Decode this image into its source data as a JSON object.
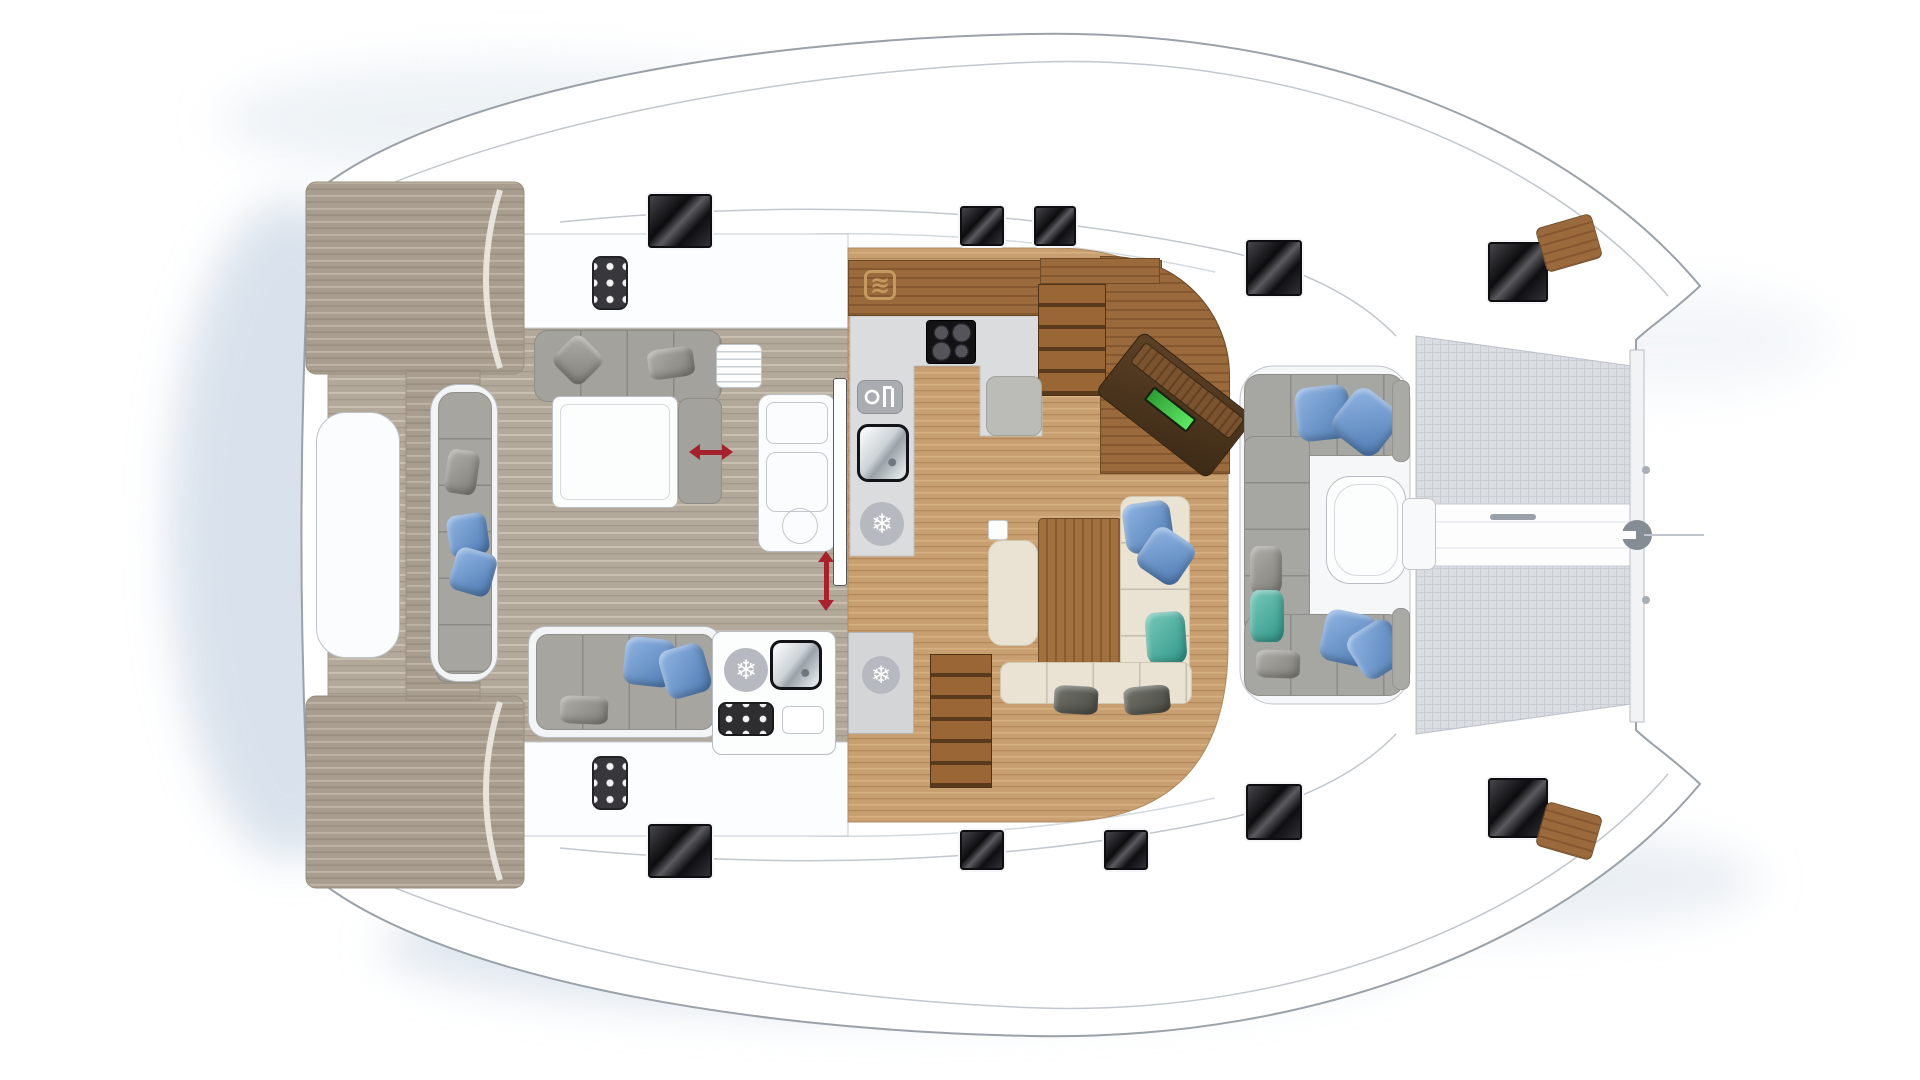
{
  "meta": {
    "subject": "catamaran-deck-plan",
    "canvas": {
      "w": 1920,
      "h": 1080
    }
  },
  "palette": {
    "hull_outline": "#9aa1a8",
    "deck_white": "#ffffff",
    "water_shadow": "#c9d6e4",
    "cockpit_teak": "#b3a99b",
    "saloon_oak": "#c89f71",
    "walnut": "#8a5b31",
    "counter_gray": "#dbdcdd",
    "sofa_gray": "#a6a5a0",
    "sofa_cream": "#eae2d2",
    "hatch_black": "#0c0c0e",
    "arrow_red": "#a5212c",
    "nav_screen_green": "#3fc24a",
    "trampoline": "#dadde2"
  },
  "glyphs": {
    "snowflake": "❄",
    "microwave": "≋"
  },
  "pillow_colors": {
    "blue": [
      "#92b6e4",
      "#4d7ab2"
    ],
    "teal": [
      "#79c9b9",
      "#2e978a"
    ],
    "gray": [
      "#aeada7",
      "#807f79"
    ],
    "dark": [
      "#72726b",
      "#4b4b45"
    ]
  },
  "items": [
    {
      "name": "stern-davit-locker",
      "kind": "box",
      "x": 316,
      "y": 412,
      "w": 84,
      "h": 246,
      "fill": "#fbfcfd",
      "stroke": "#bdc2c8",
      "r": 30
    },
    {
      "name": "stern-step-cushion-top",
      "kind": "box",
      "x": 436,
      "y": 388,
      "w": 46,
      "h": 96,
      "fill": "#9e9d98",
      "stroke": "#8a8984",
      "r": 10
    },
    {
      "name": "stern-step-cushion-bottom",
      "kind": "box",
      "x": 436,
      "y": 586,
      "w": 46,
      "h": 96,
      "fill": "#9e9d98",
      "stroke": "#8a8984",
      "r": 10
    },
    {
      "name": "transom-bench-shell",
      "kind": "box",
      "x": 430,
      "y": 384,
      "w": 68,
      "h": 298,
      "fill": "#f3f4f5",
      "stroke": "#b7bcc2",
      "r": 28
    },
    {
      "name": "transom-bench-cushions",
      "kind": "box",
      "x": 438,
      "y": 392,
      "w": 54,
      "h": 282,
      "fill": "#a6a5a0",
      "stroke": "#908f8a",
      "r": 16,
      "cls": "seam-h"
    },
    {
      "name": "transom-bench-pillow-gray",
      "kind": "pillow",
      "pc": "gray",
      "x": 446,
      "y": 450,
      "w": 32,
      "h": 44,
      "rot": 8
    },
    {
      "name": "transom-bench-pillow-blue-1",
      "kind": "pillow",
      "pc": "blue",
      "x": 448,
      "y": 514,
      "w": 40,
      "h": 42,
      "rot": -8
    },
    {
      "name": "transom-bench-pillow-blue-2",
      "kind": "pillow",
      "pc": "blue",
      "x": 452,
      "y": 550,
      "w": 42,
      "h": 44,
      "rot": 16
    },
    {
      "name": "aft-sofa-top",
      "kind": "box",
      "x": 534,
      "y": 330,
      "w": 188,
      "h": 72,
      "fill": "#a3a29d",
      "stroke": "#8d8c87",
      "r": 14,
      "cls": "seam-v"
    },
    {
      "name": "aft-sofa-top-return",
      "kind": "box",
      "x": 678,
      "y": 398,
      "w": 44,
      "h": 106,
      "fill": "#a3a29d",
      "stroke": "#8d8c87",
      "r": 10
    },
    {
      "name": "aft-sofa-top-pillow-1",
      "kind": "pillow",
      "pc": "gray",
      "x": 558,
      "y": 340,
      "w": 40,
      "h": 40,
      "rot": 45
    },
    {
      "name": "aft-sofa-top-pillow-2",
      "kind": "pillow",
      "pc": "gray",
      "x": 648,
      "y": 348,
      "w": 46,
      "h": 30,
      "rot": -8
    },
    {
      "name": "cockpit-table",
      "kind": "table",
      "x": 552,
      "y": 396,
      "w": 126,
      "h": 112,
      "r": 8
    },
    {
      "name": "aft-sofa-bottom-shell",
      "kind": "box",
      "x": 528,
      "y": 626,
      "w": 194,
      "h": 112,
      "fill": "#f3f4f5",
      "stroke": "#b7bcc2",
      "r": 18
    },
    {
      "name": "aft-sofa-bottom-cushions",
      "kind": "box",
      "x": 536,
      "y": 634,
      "w": 178,
      "h": 96,
      "fill": "#a6a5a0",
      "stroke": "#908f8a",
      "r": 12,
      "cls": "seam-v"
    },
    {
      "name": "aft-sofa-bottom-pillow-blue-1",
      "kind": "pillow",
      "pc": "blue",
      "x": 624,
      "y": 638,
      "w": 50,
      "h": 48,
      "rot": 6
    },
    {
      "name": "aft-sofa-bottom-pillow-blue-2",
      "kind": "pillow",
      "pc": "blue",
      "x": 662,
      "y": 646,
      "w": 46,
      "h": 50,
      "rot": -16
    },
    {
      "name": "aft-sofa-bottom-pillow-gray",
      "kind": "pillow",
      "pc": "gray",
      "x": 560,
      "y": 696,
      "w": 48,
      "h": 28,
      "rot": 2
    },
    {
      "name": "transom-control-panel-top",
      "kind": "sixdot",
      "x": 592,
      "y": 256,
      "w": 36,
      "h": 54
    },
    {
      "name": "transom-control-panel-bottom",
      "kind": "sixdot",
      "x": 592,
      "y": 756,
      "w": 36,
      "h": 54
    },
    {
      "name": "cockpit-louver-vent",
      "kind": "louver",
      "x": 716,
      "y": 344,
      "w": 46,
      "h": 44
    },
    {
      "name": "helm-console-base",
      "kind": "box",
      "x": 758,
      "y": 394,
      "w": 78,
      "h": 158,
      "fill": "#fbfcfd",
      "stroke": "#b8bdc3",
      "r": 12
    },
    {
      "name": "helm-console-panel-1",
      "kind": "box",
      "x": 766,
      "y": 402,
      "w": 62,
      "h": 42,
      "stroke": "#c3c8ce",
      "r": 8
    },
    {
      "name": "helm-console-panel-2",
      "kind": "box",
      "x": 766,
      "y": 452,
      "w": 62,
      "h": 60,
      "stroke": "#c3c8ce",
      "r": 10
    },
    {
      "name": "helm-console-circle",
      "kind": "circle",
      "x": 782,
      "y": 508,
      "w": 36,
      "h": 36
    },
    {
      "name": "wet-bar",
      "kind": "box",
      "x": 712,
      "y": 631,
      "w": 124,
      "h": 124,
      "fill": "#fcfdfd",
      "stroke": "#b7bcc2",
      "r": 10
    },
    {
      "name": "wet-bar-fridge-icon",
      "kind": "snowflake",
      "x": 724,
      "y": 648,
      "w": 44,
      "h": 44
    },
    {
      "name": "wet-bar-sink",
      "kind": "sink",
      "x": 770,
      "y": 640,
      "w": 52,
      "h": 50
    },
    {
      "name": "wet-bar-grill",
      "kind": "grill",
      "x": 718,
      "y": 702,
      "w": 56,
      "h": 34
    },
    {
      "name": "wet-bar-tray",
      "kind": "box",
      "x": 782,
      "y": 706,
      "w": 42,
      "h": 28,
      "fill": "#ffffff",
      "stroke": "#c3c8ce",
      "r": 6
    },
    {
      "name": "sliding-door-panel",
      "kind": "box",
      "x": 833,
      "y": 378,
      "w": 14,
      "h": 208,
      "fill": "#ffffff",
      "stroke": "#55585c",
      "r": 3
    },
    {
      "name": "door-slide-arrow",
      "kind": "arrow-v",
      "x": 818,
      "y": 552,
      "w": 16,
      "h": 58
    },
    {
      "name": "window-slide-arrow",
      "kind": "arrow-h",
      "x": 690,
      "y": 444,
      "w": 42,
      "h": 16
    },
    {
      "name": "galley-worktop",
      "kind": "wood-h",
      "x": 848,
      "y": 260,
      "w": 314,
      "h": 56
    },
    {
      "name": "microwave-icon",
      "kind": "microwave",
      "x": 864,
      "y": 270,
      "w": 32,
      "h": 30
    },
    {
      "name": "cooktop",
      "kind": "cooktop",
      "x": 926,
      "y": 320,
      "w": 50,
      "h": 44
    },
    {
      "name": "dishwasher-icon",
      "kind": "dishwasher",
      "x": 857,
      "y": 380,
      "w": 46,
      "h": 34
    },
    {
      "name": "galley-sink",
      "kind": "sink",
      "x": 857,
      "y": 424,
      "w": 52,
      "h": 58
    },
    {
      "name": "galley-fridge-icon",
      "kind": "snowflake",
      "x": 860,
      "y": 502,
      "w": 44,
      "h": 44
    },
    {
      "name": "saloon-fridge-cabinet",
      "kind": "box",
      "x": 848,
      "y": 632,
      "w": 66,
      "h": 102,
      "fill": "#d3d5d7",
      "stroke": "#b2b4b6",
      "r": 2
    },
    {
      "name": "saloon-fridge-icon",
      "kind": "snowflake",
      "x": 862,
      "y": 656,
      "w": 38,
      "h": 38
    },
    {
      "name": "walnut-corner-floor",
      "kind": "wood-h",
      "x": 1100,
      "y": 256,
      "w": 130,
      "h": 218,
      "br": "0 120px 0 0"
    },
    {
      "name": "stair-landing-port",
      "kind": "wood-h",
      "x": 1040,
      "y": 258,
      "w": 120,
      "h": 26
    },
    {
      "name": "stairs-port-hull",
      "kind": "steps",
      "x": 1038,
      "y": 284,
      "w": 68,
      "h": 112
    },
    {
      "name": "stairs-starboard-hull",
      "kind": "steps",
      "x": 930,
      "y": 654,
      "w": 62,
      "h": 134
    },
    {
      "name": "nav-seat",
      "kind": "box",
      "x": 986,
      "y": 376,
      "w": 56,
      "h": 60,
      "fill": "#bbbbb7",
      "stroke": "#a3a29d",
      "r": 10
    },
    {
      "name": "nav-desk",
      "kind": "navdesk",
      "x": 1104,
      "y": 366,
      "w": 142,
      "h": 78,
      "rot": 38
    },
    {
      "name": "saloon-side-cube",
      "kind": "box",
      "x": 988,
      "y": 520,
      "w": 20,
      "h": 20,
      "fill": "#fdfdfd",
      "stroke": "#c6cbd0",
      "r": 3
    },
    {
      "name": "dining-chaise",
      "kind": "box",
      "x": 988,
      "y": 540,
      "w": 50,
      "h": 106,
      "fill": "#eae2d2",
      "stroke": "#d2c8b2",
      "r": 14
    },
    {
      "name": "dining-table",
      "kind": "wood-v",
      "x": 1038,
      "y": 518,
      "w": 84,
      "h": 150,
      "r": 5
    },
    {
      "name": "dining-sofa",
      "kind": "box",
      "x": 1120,
      "y": 496,
      "w": 70,
      "h": 188,
      "fill": "#eae2d2",
      "stroke": "#d2c8b2",
      "r": 12,
      "cls": "seam-h"
    },
    {
      "name": "dining-sofa-pillow-blue-1",
      "kind": "pillow",
      "pc": "blue",
      "x": 1124,
      "y": 502,
      "w": 48,
      "h": 50,
      "rot": -8
    },
    {
      "name": "dining-sofa-pillow-blue-2",
      "kind": "pillow",
      "pc": "blue",
      "x": 1142,
      "y": 532,
      "w": 48,
      "h": 48,
      "rot": 34
    },
    {
      "name": "dining-sofa-pillow-teal",
      "kind": "pillow",
      "pc": "teal",
      "x": 1146,
      "y": 612,
      "w": 40,
      "h": 52,
      "rot": -4
    },
    {
      "name": "dining-bench",
      "kind": "box",
      "x": 1000,
      "y": 662,
      "w": 192,
      "h": 42,
      "fill": "#eae2d2",
      "stroke": "#d2c8b2",
      "r": 10,
      "cls": "seam-v"
    },
    {
      "name": "dining-bench-pillow-1",
      "kind": "pillow",
      "pc": "dark",
      "x": 1054,
      "y": 686,
      "w": 44,
      "h": 28,
      "rot": 3
    },
    {
      "name": "dining-bench-pillow-2",
      "kind": "pillow",
      "pc": "dark",
      "x": 1124,
      "y": 686,
      "w": 46,
      "h": 28,
      "rot": -5
    },
    {
      "name": "fwd-cockpit-sofa-top",
      "kind": "box",
      "x": 1244,
      "y": 374,
      "w": 160,
      "h": 82,
      "fill": "#a6a6a2",
      "stroke": "#8e8d88",
      "r": 16,
      "cls": "seam-v"
    },
    {
      "name": "fwd-cockpit-sofa-left",
      "kind": "box",
      "x": 1244,
      "y": 436,
      "w": 66,
      "h": 198,
      "fill": "#a6a6a2",
      "stroke": "#8e8d88",
      "r": 10,
      "cls": "seam-h"
    },
    {
      "name": "fwd-cockpit-sofa-bottom",
      "kind": "box",
      "x": 1244,
      "y": 614,
      "w": 160,
      "h": 82,
      "fill": "#a6a6a2",
      "stroke": "#8e8d88",
      "r": 16,
      "cls": "seam-v"
    },
    {
      "name": "fwd-pillow-blue-1",
      "kind": "pillow",
      "pc": "blue",
      "x": 1296,
      "y": 386,
      "w": 54,
      "h": 54,
      "rot": -6
    },
    {
      "name": "fwd-pillow-blue-2",
      "kind": "pillow",
      "pc": "blue",
      "x": 1338,
      "y": 394,
      "w": 56,
      "h": 56,
      "rot": 38
    },
    {
      "name": "fwd-pillow-gray-1",
      "kind": "pillow",
      "pc": "gray",
      "x": 1250,
      "y": 546,
      "w": 32,
      "h": 48,
      "rot": 0
    },
    {
      "name": "fwd-pillow-teal",
      "kind": "pillow",
      "pc": "teal",
      "x": 1250,
      "y": 590,
      "w": 34,
      "h": 52,
      "rot": 0
    },
    {
      "name": "fwd-pillow-gray-2",
      "kind": "pillow",
      "pc": "gray",
      "x": 1256,
      "y": 650,
      "w": 44,
      "h": 28,
      "rot": 2
    },
    {
      "name": "fwd-pillow-blue-3",
      "kind": "pillow",
      "pc": "blue",
      "x": 1322,
      "y": 612,
      "w": 52,
      "h": 52,
      "rot": 12
    },
    {
      "name": "fwd-pillow-blue-4",
      "kind": "pillow",
      "pc": "blue",
      "x": 1352,
      "y": 624,
      "w": 50,
      "h": 50,
      "rot": -32
    },
    {
      "name": "fwd-cockpit-table",
      "kind": "table",
      "x": 1326,
      "y": 476,
      "w": 80,
      "h": 108,
      "r": 24
    },
    {
      "name": "mast-step-console",
      "kind": "box",
      "x": 1402,
      "y": 498,
      "w": 34,
      "h": 72,
      "fill": "#f8f9fa",
      "stroke": "#c0c5cb",
      "r": 8
    },
    {
      "name": "trampoline-pad-top",
      "kind": "box",
      "x": 1392,
      "y": 380,
      "w": 18,
      "h": 82,
      "fill": "#a9a9a5",
      "stroke": "#949390",
      "r": 8
    },
    {
      "name": "trampoline-pad-bottom",
      "kind": "box",
      "x": 1392,
      "y": 608,
      "w": 18,
      "h": 82,
      "fill": "#a9a9a5",
      "stroke": "#949390",
      "r": 8
    },
    {
      "name": "deck-hatch-1",
      "kind": "hatch",
      "x": 648,
      "y": 194,
      "w": 64,
      "h": 54
    },
    {
      "name": "deck-hatch-2",
      "kind": "hatch",
      "x": 960,
      "y": 206,
      "w": 44,
      "h": 40
    },
    {
      "name": "deck-hatch-3",
      "kind": "hatch",
      "x": 1034,
      "y": 206,
      "w": 42,
      "h": 40
    },
    {
      "name": "deck-hatch-4",
      "kind": "hatch",
      "x": 1246,
      "y": 240,
      "w": 56,
      "h": 56
    },
    {
      "name": "deck-hatch-5",
      "kind": "hatch",
      "x": 1488,
      "y": 242,
      "w": 60,
      "h": 60
    },
    {
      "name": "deck-hatch-6",
      "kind": "hatch",
      "x": 648,
      "y": 824,
      "w": 64,
      "h": 54
    },
    {
      "name": "deck-hatch-7",
      "kind": "hatch",
      "x": 960,
      "y": 830,
      "w": 44,
      "h": 40
    },
    {
      "name": "deck-hatch-8",
      "kind": "hatch",
      "x": 1104,
      "y": 830,
      "w": 44,
      "h": 40
    },
    {
      "name": "deck-hatch-9",
      "kind": "hatch",
      "x": 1246,
      "y": 784,
      "w": 56,
      "h": 56
    },
    {
      "name": "deck-hatch-10",
      "kind": "hatch",
      "x": 1488,
      "y": 778,
      "w": 60,
      "h": 60
    },
    {
      "name": "bow-vent-top",
      "kind": "wood-h",
      "x": 1540,
      "y": 220,
      "w": 58,
      "h": 46,
      "rot": -16,
      "r": 6
    },
    {
      "name": "bow-vent-bottom",
      "kind": "wood-h",
      "x": 1540,
      "y": 808,
      "w": 58,
      "h": 46,
      "rot": 16,
      "r": 6
    }
  ]
}
